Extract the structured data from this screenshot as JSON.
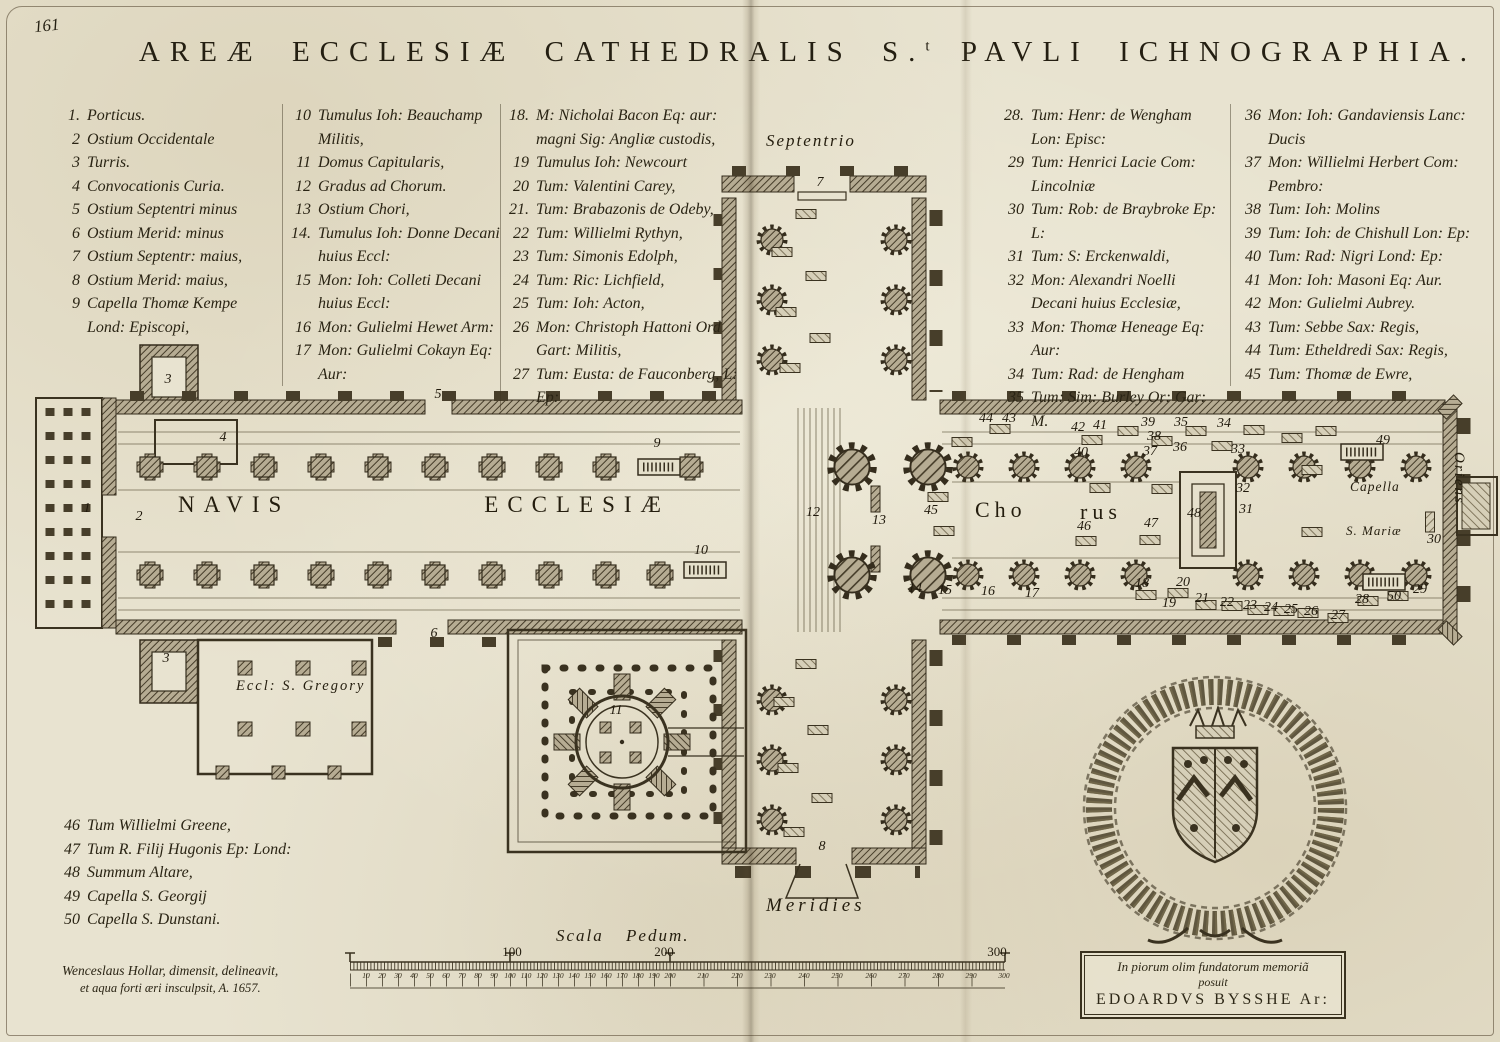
{
  "page": {
    "number": "161"
  },
  "title": {
    "part1": "AREÆ ECCLESIÆ CATHEDRALIS S.",
    "sup": "t",
    "part2": " PAVLI ICHNOGRAPHIA."
  },
  "legend": {
    "col1": [
      {
        "n": "1.",
        "text": "Porticus."
      },
      {
        "n": "2",
        "text": "Ostium Occidentale"
      },
      {
        "n": "3",
        "text": "Turris."
      },
      {
        "n": "4",
        "text": "Convocationis Curia."
      },
      {
        "n": "5",
        "text": "Ostium Septentri minus"
      },
      {
        "n": "6",
        "text": "Ostium Merid: minus"
      },
      {
        "n": "7",
        "text": "Ostium Septentr: maius,"
      },
      {
        "n": "8",
        "text": "Ostium Merid: maius,"
      },
      {
        "n": "9",
        "text": "Capella Thomæ Kempe Lond: Episcopi,"
      }
    ],
    "col2": [
      {
        "n": "10",
        "text": "Tumulus Ioh: Beauchamp Militis,"
      },
      {
        "n": "11",
        "text": "Domus Capitularis,"
      },
      {
        "n": "12",
        "text": "Gradus ad Chorum."
      },
      {
        "n": "13",
        "text": "Ostium Chori,"
      },
      {
        "n": "14.",
        "text": "Tumulus Ioh: Donne Decani huius Eccl:"
      },
      {
        "n": "15",
        "text": "Mon: Ioh: Colleti Decani huius Eccl:"
      },
      {
        "n": "16",
        "text": "Mon: Gulielmi Hewet Arm:"
      },
      {
        "n": "17",
        "text": "Mon: Gulielmi Cokayn Eq: Aur:"
      }
    ],
    "col3": [
      {
        "n": "18.",
        "text": "M: Nicholai Bacon Eq: aur: magni Sig: Angliæ custodis,"
      },
      {
        "n": "19",
        "text": "Tumulus Ioh: Newcourt"
      },
      {
        "n": "20",
        "text": "Tum: Valentini Carey,"
      },
      {
        "n": "21.",
        "text": "Tum: Brabazonis de Odeby,"
      },
      {
        "n": "22",
        "text": "Tum: Willielmi Rythyn,"
      },
      {
        "n": "23",
        "text": "Tum: Simonis Edolph,"
      },
      {
        "n": "24",
        "text": "Tum: Ric: Lichfield,"
      },
      {
        "n": "25",
        "text": "Tum: Ioh: Acton,"
      },
      {
        "n": "26",
        "text": "Mon: Christoph Hattoni Ord Gart: Militis,"
      },
      {
        "n": "27",
        "text": "Tum: Eusta: de Fauconberg, L: Ep:"
      }
    ],
    "col4": [
      {
        "n": "28.",
        "text": "Tum: Henr: de Wengham Lon: Episc:"
      },
      {
        "n": "29",
        "text": "Tum: Henrici Lacie Com: Lincolniæ"
      },
      {
        "n": "30",
        "text": "Tum: Rob: de Braybroke Ep: L:"
      },
      {
        "n": "31",
        "text": "Tum: S: Erckenwaldi,"
      },
      {
        "n": "32",
        "text": "Mon: Alexandri Noelli Decani huius Ecclesiæ,"
      },
      {
        "n": "33",
        "text": "Mon: Thomæ Heneage Eq: Aur:"
      },
      {
        "n": "34",
        "text": "Tum: Rad: de Hengham"
      },
      {
        "n": "35",
        "text": "Tum: Sim: Burley Or: Gar: M."
      }
    ],
    "col5": [
      {
        "n": "36",
        "text": "Mon: Ioh: Gandaviensis Lanc: Ducis"
      },
      {
        "n": "37",
        "text": "Mon: Willielmi Herbert Com: Pembro:"
      },
      {
        "n": "38",
        "text": "Tum: Ioh: Molins"
      },
      {
        "n": "39",
        "text": "Tum: Ioh: de Chishull Lon: Ep:"
      },
      {
        "n": "40",
        "text": "Tum: Rad: Nigri Lond: Ep:"
      },
      {
        "n": "41",
        "text": "Mon: Ioh: Masoni Eq: Aur."
      },
      {
        "n": "42",
        "text": "Mon: Gulielmi Aubrey."
      },
      {
        "n": "43",
        "text": "Tum: Sebbe Sax: Regis,"
      },
      {
        "n": "44",
        "text": "Tum: Etheldredi Sax: Regis,"
      },
      {
        "n": "45",
        "text": "Tum: Thomæ de Ewre,"
      }
    ],
    "extra": [
      {
        "n": "46",
        "text": "Tum Willielmi Greene,"
      },
      {
        "n": "47",
        "text": "Tum R. Filij Hugonis Ep: Lond:"
      },
      {
        "n": "48",
        "text": "Summum Altare,"
      },
      {
        "n": "49",
        "text": "Capella S. Georgij"
      },
      {
        "n": "50",
        "text": "Capella S. Dunstani."
      }
    ]
  },
  "plan": {
    "labels": {
      "septentrio": "Septentrio",
      "meridies": "Meridies",
      "oriens": "Oriens",
      "navis1": "NAVIS",
      "navis2": "ECCLESIÆ",
      "chorus1": "Cho",
      "chorus2": "rus",
      "capella1": "Capella",
      "capella2": "S. Mariæ",
      "gregory": "Eccl: S. Gregory"
    },
    "markers": [
      {
        "n": "1",
        "x": 87,
        "y": 509
      },
      {
        "n": "2",
        "x": 139,
        "y": 517
      },
      {
        "n": "3",
        "x": 168,
        "y": 380
      },
      {
        "n": "3",
        "x": 166,
        "y": 659
      },
      {
        "n": "4",
        "x": 223,
        "y": 438
      },
      {
        "n": "5",
        "x": 438,
        "y": 395
      },
      {
        "n": "6",
        "x": 434,
        "y": 634
      },
      {
        "n": "7",
        "x": 820,
        "y": 183
      },
      {
        "n": "8",
        "x": 822,
        "y": 847
      },
      {
        "n": "9",
        "x": 657,
        "y": 444
      },
      {
        "n": "10",
        "x": 701,
        "y": 551
      },
      {
        "n": "11",
        "x": 616,
        "y": 711
      },
      {
        "n": "12",
        "x": 813,
        "y": 513
      },
      {
        "n": "13",
        "x": 879,
        "y": 521
      },
      {
        "n": "14",
        "x": 915,
        "y": 589
      },
      {
        "n": "15",
        "x": 945,
        "y": 591
      },
      {
        "n": "16",
        "x": 988,
        "y": 592
      },
      {
        "n": "17",
        "x": 1032,
        "y": 594
      },
      {
        "n": "18",
        "x": 1142,
        "y": 584
      },
      {
        "n": "19",
        "x": 1169,
        "y": 604
      },
      {
        "n": "20",
        "x": 1183,
        "y": 583
      },
      {
        "n": "21",
        "x": 1202,
        "y": 599
      },
      {
        "n": "22",
        "x": 1227,
        "y": 603
      },
      {
        "n": "23",
        "x": 1250,
        "y": 606
      },
      {
        "n": "24",
        "x": 1271,
        "y": 608
      },
      {
        "n": "25",
        "x": 1291,
        "y": 610
      },
      {
        "n": "26",
        "x": 1311,
        "y": 612
      },
      {
        "n": "27",
        "x": 1338,
        "y": 616
      },
      {
        "n": "28",
        "x": 1362,
        "y": 600
      },
      {
        "n": "29",
        "x": 1420,
        "y": 590
      },
      {
        "n": "30",
        "x": 1434,
        "y": 540
      },
      {
        "n": "31",
        "x": 1246,
        "y": 510
      },
      {
        "n": "32",
        "x": 1243,
        "y": 489
      },
      {
        "n": "33",
        "x": 1238,
        "y": 450
      },
      {
        "n": "34",
        "x": 1224,
        "y": 424
      },
      {
        "n": "35",
        "x": 1181,
        "y": 423
      },
      {
        "n": "36",
        "x": 1180,
        "y": 448
      },
      {
        "n": "37",
        "x": 1150,
        "y": 452
      },
      {
        "n": "38",
        "x": 1154,
        "y": 437
      },
      {
        "n": "39",
        "x": 1148,
        "y": 423
      },
      {
        "n": "40",
        "x": 1081,
        "y": 453
      },
      {
        "n": "41",
        "x": 1100,
        "y": 426
      },
      {
        "n": "42",
        "x": 1078,
        "y": 428
      },
      {
        "n": "43",
        "x": 1009,
        "y": 419
      },
      {
        "n": "44",
        "x": 986,
        "y": 419
      },
      {
        "n": "45",
        "x": 931,
        "y": 511
      },
      {
        "n": "46",
        "x": 1084,
        "y": 527
      },
      {
        "n": "47",
        "x": 1151,
        "y": 524
      },
      {
        "n": "48",
        "x": 1194,
        "y": 514
      },
      {
        "n": "49",
        "x": 1383,
        "y": 441
      },
      {
        "n": "50",
        "x": 1394,
        "y": 597
      }
    ]
  },
  "scale": {
    "label": "Scala Pedum.",
    "major": [
      {
        "t": "100",
        "x": 512
      },
      {
        "t": "200",
        "x": 664
      },
      {
        "t": "300",
        "x": 997
      }
    ],
    "ticks": [
      {
        "v": "10",
        "x": 366
      },
      {
        "v": "20",
        "x": 382
      },
      {
        "v": "30",
        "x": 398
      },
      {
        "v": "40",
        "x": 414
      },
      {
        "v": "50",
        "x": 430
      },
      {
        "v": "60",
        "x": 446
      },
      {
        "v": "70",
        "x": 462
      },
      {
        "v": "80",
        "x": 478
      },
      {
        "v": "90",
        "x": 494
      },
      {
        "v": "100",
        "x": 510
      },
      {
        "v": "110",
        "x": 526
      },
      {
        "v": "120",
        "x": 542
      },
      {
        "v": "130",
        "x": 558
      },
      {
        "v": "140",
        "x": 574
      },
      {
        "v": "150",
        "x": 590
      },
      {
        "v": "160",
        "x": 606
      },
      {
        "v": "170",
        "x": 622
      },
      {
        "v": "180",
        "x": 638
      },
      {
        "v": "190",
        "x": 654
      },
      {
        "v": "200",
        "x": 670
      },
      {
        "v": "210",
        "x": 703
      },
      {
        "v": "220",
        "x": 737
      },
      {
        "v": "230",
        "x": 770
      },
      {
        "v": "240",
        "x": 804
      },
      {
        "v": "250",
        "x": 837
      },
      {
        "v": "260",
        "x": 871
      },
      {
        "v": "270",
        "x": 904
      },
      {
        "v": "280",
        "x": 938
      },
      {
        "v": "290",
        "x": 971
      },
      {
        "v": "300",
        "x": 1004
      }
    ]
  },
  "signature": {
    "line1": "Wenceslaus Hollar,  dimensit, delineavit,",
    "line2": "et aqua forti æri insculpsit,   A. 1657."
  },
  "cartouche": {
    "line1": "In piorum olim fundatorum memoriã",
    "line2": "posuit",
    "line3": "EDOARDVS BYSSHE Ar:"
  }
}
